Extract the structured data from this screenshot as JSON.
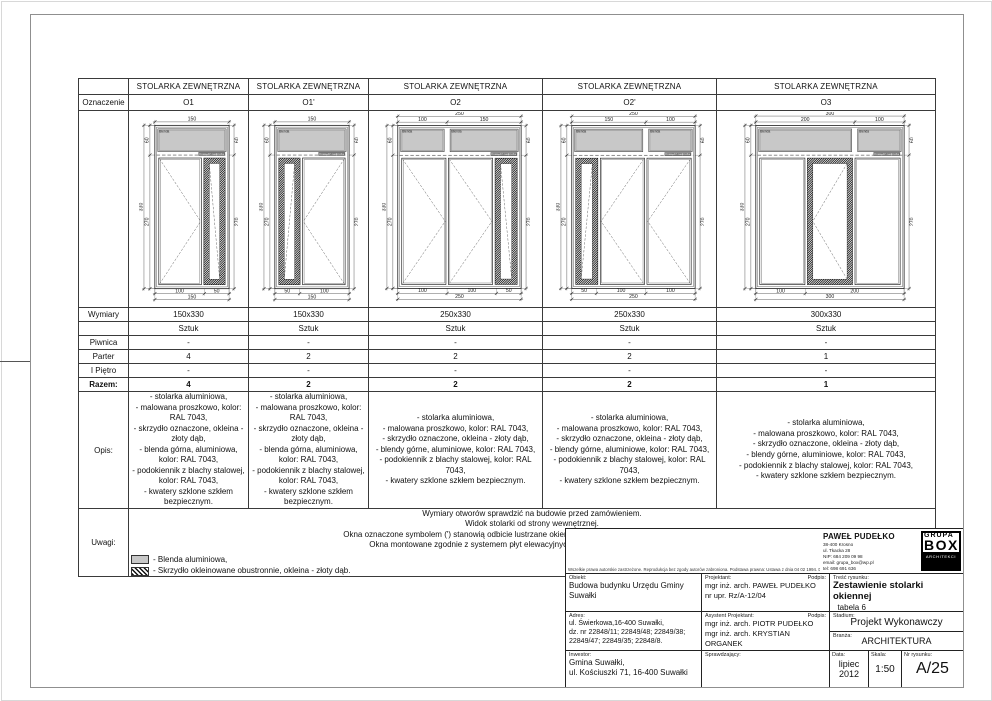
{
  "table": {
    "header": "STOLARKA ZEWNĘTRZNA",
    "corner": "Oznaczenie",
    "rows": {
      "wymiary": "Wymiary",
      "sztuk": "Sztuk",
      "piwnica": "Piwnica",
      "parter": "Parter",
      "pietro": "I Piętro",
      "razem": "Razem:",
      "opis": "Opis:",
      "uwagi": "Uwagi:"
    },
    "columns": [
      {
        "mark": "O1",
        "wymiary": "150x330",
        "piwnica": "-",
        "parter": "4",
        "pietro": "-",
        "razem": "4",
        "opis": [
          "- stolarka aluminiowa,",
          "- malowana proszkowo, kolor: RAL 7043,",
          "- skrzydło oznaczone, okleina - złoty dąb,",
          "- blenda górna, aluminiowa, kolor: RAL 7043,",
          "- podokiennik z blachy stalowej, kolor: RAL 7043,",
          "- kwatery szklone szkłem bezpiecznym."
        ]
      },
      {
        "mark": "O1'",
        "wymiary": "150x330",
        "piwnica": "-",
        "parter": "2",
        "pietro": "-",
        "razem": "2",
        "opis": [
          "- stolarka aluminiowa,",
          "- malowana proszkowo, kolor: RAL 7043,",
          "- skrzydło oznaczone, okleina - złoty dąb,",
          "- blenda górna, aluminiowa, kolor: RAL 7043,",
          "- podokiennik z blachy stalowej, kolor: RAL 7043,",
          "- kwatery szklone szkłem bezpiecznym."
        ]
      },
      {
        "mark": "O2",
        "wymiary": "250x330",
        "piwnica": "-",
        "parter": "2",
        "pietro": "-",
        "razem": "2",
        "opis": [
          "- stolarka aluminiowa,",
          "- malowana proszkowo, kolor: RAL 7043,",
          "- skrzydło oznaczone, okleina - złoty dąb,",
          "- blendy górne, aluminiowe, kolor: RAL 7043,",
          "- podokiennik z blachy stalowej, kolor: RAL 7043,",
          "- kwatery szklone szkłem bezpiecznym."
        ]
      },
      {
        "mark": "O2'",
        "wymiary": "250x330",
        "piwnica": "-",
        "parter": "2",
        "pietro": "-",
        "razem": "2",
        "opis": [
          "- stolarka aluminiowa,",
          "- malowana proszkowo, kolor: RAL 7043,",
          "- skrzydło oznaczone, okleina - złoty dąb,",
          "- blendy górne, aluminiowe, kolor: RAL 7043,",
          "- podokiennik z blachy stalowej, kolor: RAL 7043,",
          "- kwatery szklone szkłem bezpiecznym."
        ]
      },
      {
        "mark": "O3",
        "wymiary": "300x330",
        "piwnica": "-",
        "parter": "1",
        "pietro": "-",
        "razem": "1",
        "opis": [
          "- stolarka aluminiowa,",
          "- malowana proszkowo, kolor: RAL 7043,",
          "- skrzydło oznaczone, okleina - złoty dąb,",
          "- blendy górne, aluminiowe, kolor: RAL 7043,",
          "- podokiennik z blachy stalowej, kolor: RAL 7043,",
          "- kwatery szklone szkłem bezpiecznym."
        ]
      }
    ]
  },
  "windows_common": {
    "height": 330,
    "top_zone": 60,
    "blenda_label": "Blenda",
    "lintel_label": "Krawędź nadproża",
    "left_outer": [
      330
    ],
    "left_inner": [
      60,
      270
    ],
    "right": [
      60,
      270
    ],
    "blenda_fill": "#c8c8c8",
    "line_color": "#1a1a1a"
  },
  "windows": [
    {
      "id": "O1",
      "w": 150,
      "top_dims": [
        [
          150
        ]
      ],
      "bottom_dims": [
        [
          100,
          50
        ],
        [
          150
        ]
      ],
      "blendas": [
        150
      ],
      "leaves": [
        {
          "w": 100,
          "type": "casement",
          "apex": "right"
        },
        {
          "w": 50,
          "type": "veneer",
          "diag": "tlbr"
        }
      ]
    },
    {
      "id": "O1p",
      "w": 150,
      "top_dims": [
        [
          150
        ]
      ],
      "bottom_dims": [
        [
          50,
          100
        ],
        [
          150
        ]
      ],
      "blendas": [
        150
      ],
      "leaves": [
        {
          "w": 50,
          "type": "veneer",
          "diag": "trbl"
        },
        {
          "w": 100,
          "type": "casement",
          "apex": "left"
        }
      ]
    },
    {
      "id": "O2",
      "w": 250,
      "top_dims": [
        [
          250
        ],
        [
          100,
          150
        ]
      ],
      "bottom_dims": [
        [
          100,
          100,
          50
        ],
        [
          250
        ]
      ],
      "blendas": [
        100,
        150
      ],
      "leaves": [
        {
          "w": 100,
          "type": "casement",
          "apex": "right"
        },
        {
          "w": 100,
          "type": "casement",
          "apex": "right"
        },
        {
          "w": 50,
          "type": "veneer",
          "diag": "tlbr"
        }
      ]
    },
    {
      "id": "O2p",
      "w": 250,
      "top_dims": [
        [
          250
        ],
        [
          150,
          100
        ]
      ],
      "bottom_dims": [
        [
          50,
          100,
          100
        ],
        [
          250
        ]
      ],
      "blendas": [
        150,
        100
      ],
      "leaves": [
        {
          "w": 50,
          "type": "veneer",
          "diag": "trbl"
        },
        {
          "w": 100,
          "type": "casement",
          "apex": "left"
        },
        {
          "w": 100,
          "type": "casement",
          "apex": "left"
        }
      ]
    },
    {
      "id": "O3",
      "w": 300,
      "top_dims": [
        [
          300
        ],
        [
          200,
          100
        ]
      ],
      "bottom_dims": [
        [
          100,
          200
        ],
        [
          300
        ]
      ],
      "blendas": [
        200,
        100
      ],
      "leaves": [
        {
          "w": 100,
          "type": "fixed"
        },
        {
          "w": 100,
          "type": "veneer",
          "apex": "left"
        },
        {
          "w": 100,
          "type": "fixed"
        }
      ]
    }
  ],
  "uwagi": {
    "notes": [
      "Wymiary otworów sprawdzić na budowie przed zamówieniem.",
      "Widok stolarki od strony wewnętrznej.",
      "Okna oznaczone symbolem (') stanowią odbicie lustrzane okien o tym samym numerze bez ( ' ) np. O1|O1'",
      "Okna montowane zgodnie z systemem płyt elewacyjnych, przed płaszczyzną ściany nośnej."
    ],
    "legend": [
      {
        "label": "- Blenda aluminiowa,"
      },
      {
        "label": "- Skrzydło okleinowane obustronnie, okleina - złoty dąb."
      }
    ]
  },
  "titleblock": {
    "copyright": "Wszelkie prawa autorskie zastrzeżone. Reprodukcja bez zgody autorów zabroniona. Podstawa prawna: Ustawa z dnia 04 02 1994. Dz.U.Nr poz. 83 z dnia 23 02 1994",
    "firm": {
      "name": "PAWEŁ PUDEŁKO",
      "address_lines": [
        "38-400 Krosno",
        "ul. Tkacka 28",
        "NIP: 684 209 09 98",
        "email: grupa_box@wp.pl",
        "tel: 698 691 636"
      ]
    },
    "logo": {
      "line1": "GRUPA",
      "line2": "BOX",
      "line3": "ARCHITEKCI"
    },
    "obiekt_label": "Obiekt:",
    "obiekt_value": "Budowa budynku Urzędu Gminy Suwałki",
    "projektant_label": "Projektant:",
    "podpis_label": "Podpis:",
    "projektant_value": [
      "mgr inż. arch. PAWEŁ PUDEŁKO",
      "nr upr. Rz/A-12/04"
    ],
    "tresc_label": "Treść rysunku:",
    "tresc_value": "Zestawienie stolarki okiennej",
    "tresc_value2": "_tabela 6",
    "adres_label": "Adres:",
    "adres_value": [
      "ul. Świerkowa,16-400 Suwałki,",
      "dz. nr 22848/11; 22849/48;  22849/38;",
      "22849/47; 22849/35;  22848/8."
    ],
    "asystent_label": "Asystent Projektant:",
    "asystent_value": [
      "mgr inż. arch. PIOTR PUDEŁKO",
      "mgr inż. arch. KRYSTIAN ORGANEK"
    ],
    "stadium_label": "Stadium:",
    "stadium_value": "Projekt Wykonawczy",
    "branza_label": "Branża:",
    "branza_value": "ARCHITEKTURA",
    "inwestor_label": "Inwestor:",
    "inwestor_value": [
      "Gmina Suwałki,",
      "ul. Kościuszki 71, 16-400 Suwałki"
    ],
    "sprawdzajacy_label": "Sprawdzający:",
    "data_label": "Data:",
    "data_value": [
      "lipiec",
      "2012"
    ],
    "skala_label": "Skala:",
    "skala_value": "1:50",
    "nr_label": "Nr rysunku:",
    "nr_value": "A/25"
  }
}
